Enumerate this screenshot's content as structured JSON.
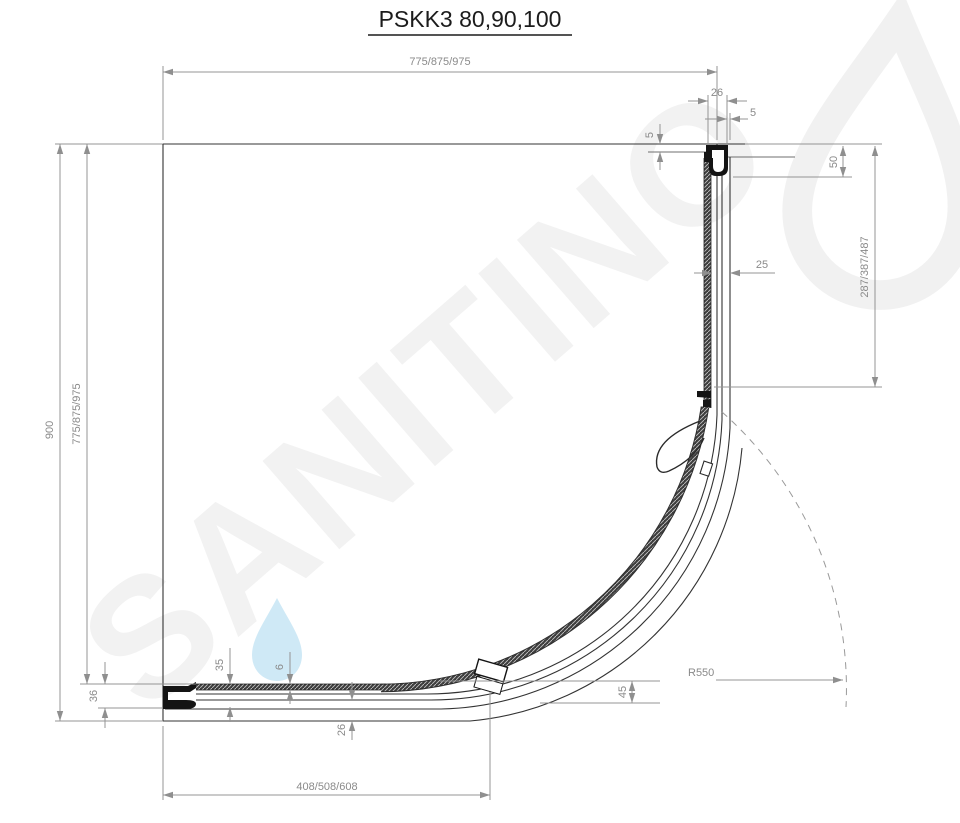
{
  "title": "PSKK3 80,90,100",
  "watermark": {
    "text": "SANITINO",
    "text_color": "#f2f2f2",
    "droplet_color": "#cfe9f6"
  },
  "colors": {
    "drawing_line": "#333333",
    "profile_fill": "#141414",
    "dimension_line": "#949494",
    "dimension_text": "#8a8a8a",
    "swing_arc": "#9a9a9a"
  },
  "dimensions": {
    "top_width": "775/875/975",
    "top_profile_depth": "26",
    "top_gap": "5",
    "glass_inset": "5",
    "bracket_height": "50",
    "right_fixed_panel": "287/387/487",
    "glass_offset": "25",
    "total_depth": "900",
    "inner_width": "775/875/975",
    "left_profile_height": "36",
    "bottom_profile_height": "35",
    "glass_thickness": "6",
    "bottom_profile_depth": "26",
    "door_edge_gap": "45",
    "bottom_fixed_panel": "408/508/608",
    "curve_radius": "R550"
  }
}
